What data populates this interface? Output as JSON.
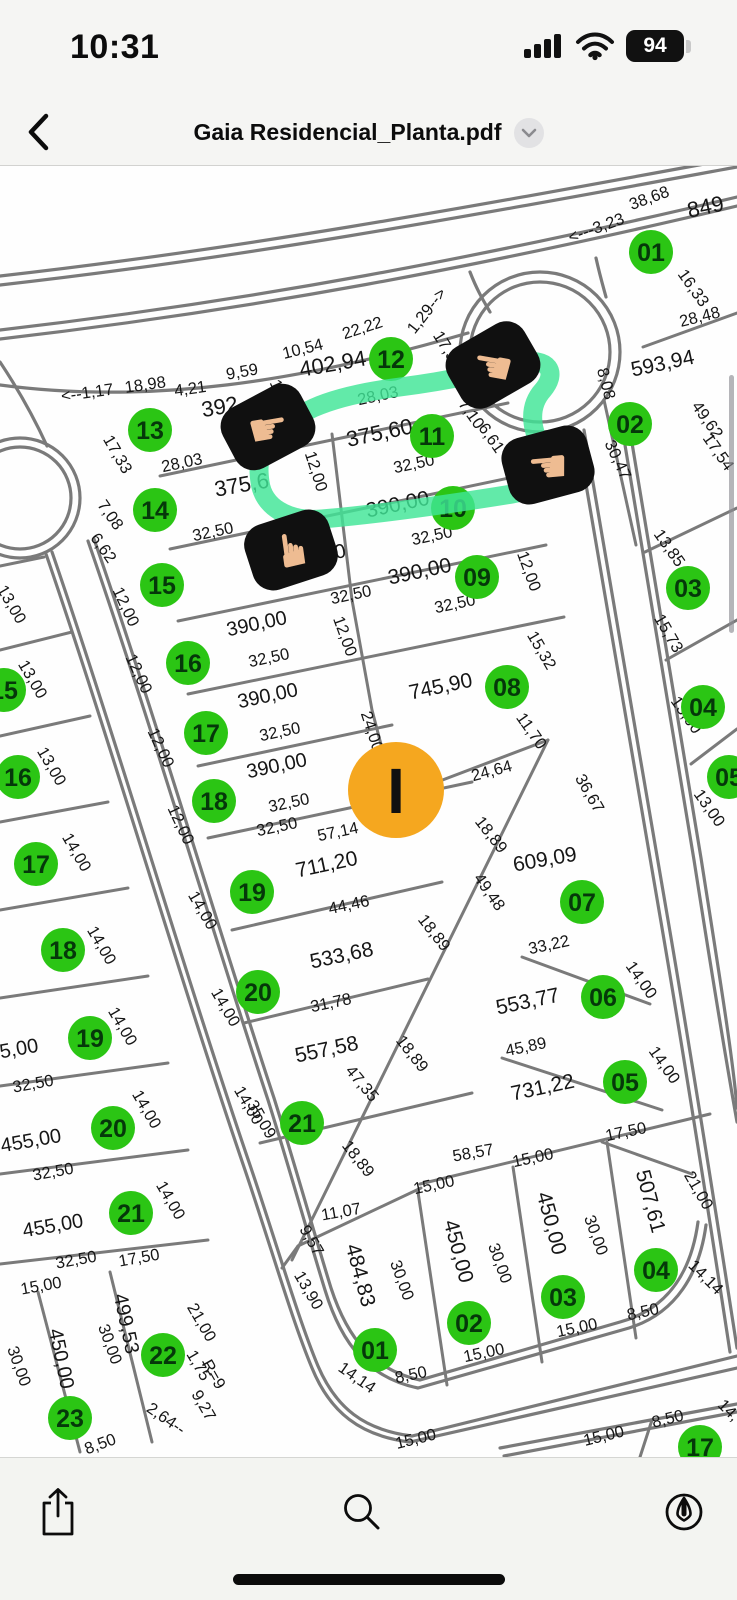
{
  "status_bar": {
    "time": "10:31",
    "battery_percent": "94",
    "icons": [
      "cellular-signal-icon",
      "wifi-icon",
      "battery-icon"
    ]
  },
  "nav_bar": {
    "title": "Gaia Residencial_Planta.pdf",
    "icons": [
      "back-chevron-icon",
      "title-disclosure-chevron-icon"
    ]
  },
  "toolbar": {
    "icons": [
      "share-icon",
      "search-icon",
      "markup-icon"
    ]
  },
  "colors": {
    "circle_green": "#2bc514",
    "circle_text": "#05380a",
    "highlight": "#3fe596",
    "marker_orange": "#f5a71f",
    "street_gray": "#7a7a7a",
    "label_black": "#161616",
    "sticker_bg": "#101010",
    "hand_skin": "#eebc92",
    "scrollbar_gray": "#8e8e93"
  },
  "map": {
    "marker": {
      "letter": "I",
      "x": 396,
      "y": 790
    },
    "stickers": [
      {
        "glyph": "☛",
        "x": 268,
        "y": 427,
        "rot": -28,
        "grot": 18
      },
      {
        "glyph": "☚",
        "x": 493,
        "y": 365,
        "rot": -30,
        "grot": 40
      },
      {
        "glyph": "☚",
        "x": 548,
        "y": 465,
        "rot": -15,
        "grot": 10
      },
      {
        "glyph": "☛",
        "x": 291,
        "y": 550,
        "rot": -18,
        "grot": -80
      }
    ],
    "lots": [
      {
        "n": "13",
        "x": 150,
        "y": 430
      },
      {
        "n": "14",
        "x": 155,
        "y": 510
      },
      {
        "n": "15",
        "x": 162,
        "y": 585
      },
      {
        "n": "16",
        "x": 188,
        "y": 663
      },
      {
        "n": "17",
        "x": 206,
        "y": 733
      },
      {
        "n": "18",
        "x": 214,
        "y": 801
      },
      {
        "n": "19",
        "x": 252,
        "y": 892
      },
      {
        "n": "20",
        "x": 258,
        "y": 992
      },
      {
        "n": "21",
        "x": 302,
        "y": 1123
      },
      {
        "n": "12",
        "x": 391,
        "y": 359
      },
      {
        "n": "11",
        "x": 432,
        "y": 436
      },
      {
        "n": "10",
        "x": 453,
        "y": 508
      },
      {
        "n": "09",
        "x": 477,
        "y": 577
      },
      {
        "n": "08",
        "x": 507,
        "y": 687
      },
      {
        "n": "07",
        "x": 582,
        "y": 902
      },
      {
        "n": "06",
        "x": 603,
        "y": 997
      },
      {
        "n": "05",
        "x": 625,
        "y": 1082
      },
      {
        "n": "01",
        "x": 651,
        "y": 252
      },
      {
        "n": "02",
        "x": 630,
        "y": 424
      },
      {
        "n": "03",
        "x": 688,
        "y": 588
      },
      {
        "n": "04",
        "x": 703,
        "y": 707
      },
      {
        "n": "05",
        "x": 729,
        "y": 777
      },
      {
        "n": "15",
        "x": 4,
        "y": 690
      },
      {
        "n": "16",
        "x": 18,
        "y": 777
      },
      {
        "n": "17",
        "x": 36,
        "y": 864
      },
      {
        "n": "18",
        "x": 63,
        "y": 950
      },
      {
        "n": "19",
        "x": 90,
        "y": 1038
      },
      {
        "n": "20",
        "x": 113,
        "y": 1128
      },
      {
        "n": "21",
        "x": 131,
        "y": 1213
      },
      {
        "n": "22",
        "x": 163,
        "y": 1355
      },
      {
        "n": "23",
        "x": 70,
        "y": 1418
      },
      {
        "n": "01",
        "x": 375,
        "y": 1350
      },
      {
        "n": "02",
        "x": 469,
        "y": 1323
      },
      {
        "n": "03",
        "x": 563,
        "y": 1297
      },
      {
        "n": "04",
        "x": 656,
        "y": 1270
      },
      {
        "n": "17",
        "x": 700,
        "y": 1447
      }
    ],
    "labels": [
      {
        "t": "<--1,17",
        "x": 88,
        "y": 398,
        "r": -8
      },
      {
        "t": "18,98",
        "x": 146,
        "y": 390,
        "r": -8
      },
      {
        "t": "4,21",
        "x": 191,
        "y": 394,
        "r": -8
      },
      {
        "t": "9,59",
        "x": 243,
        "y": 377,
        "r": -10
      },
      {
        "t": "10,54",
        "x": 304,
        "y": 354,
        "r": -14
      },
      {
        "t": "22,22",
        "x": 364,
        "y": 333,
        "r": -18
      },
      {
        "t": "402,94",
        "x": 334,
        "y": 371,
        "r": -10,
        "s": 22
      },
      {
        "t": "1,29-->",
        "x": 431,
        "y": 314,
        "r": -52
      },
      {
        "t": "17,3",
        "x": 441,
        "y": 349,
        "r": 58
      },
      {
        "t": "12,",
        "x": 274,
        "y": 393,
        "r": 66
      },
      {
        "t": "28,03",
        "x": 379,
        "y": 401,
        "r": -12
      },
      {
        "t": "392",
        "x": 221,
        "y": 414,
        "r": -10,
        "s": 22
      },
      {
        "t": "38,68",
        "x": 651,
        "y": 203,
        "r": -20
      },
      {
        "t": "849",
        "x": 707,
        "y": 214,
        "r": -12,
        "s": 22
      },
      {
        "t": "<---3,23",
        "x": 598,
        "y": 233,
        "r": -20
      },
      {
        "t": "16,33",
        "x": 689,
        "y": 291,
        "r": 55
      },
      {
        "t": "28,48",
        "x": 701,
        "y": 322,
        "r": -14
      },
      {
        "t": "593,94",
        "x": 664,
        "y": 370,
        "r": -12,
        "s": 21
      },
      {
        "t": "8,08",
        "x": 601,
        "y": 385,
        "r": 75
      },
      {
        "t": "30,47",
        "x": 613,
        "y": 462,
        "r": 65
      },
      {
        "t": "49,62",
        "x": 703,
        "y": 423,
        "r": 55
      },
      {
        "t": "17,54",
        "x": 714,
        "y": 455,
        "r": 55
      },
      {
        "t": "17,33",
        "x": 113,
        "y": 457,
        "r": 60
      },
      {
        "t": "28,03",
        "x": 183,
        "y": 468,
        "r": -12
      },
      {
        "t": "375,6",
        "x": 243,
        "y": 492,
        "r": -10,
        "s": 22
      },
      {
        "t": "32,50",
        "x": 214,
        "y": 537,
        "r": -12
      },
      {
        "t": "7,08",
        "x": 106,
        "y": 518,
        "r": 55
      },
      {
        "t": "6,62",
        "x": 99,
        "y": 551,
        "r": 55
      },
      {
        "t": "375,60",
        "x": 381,
        "y": 440,
        "r": -12,
        "s": 22
      },
      {
        "t": "32,50",
        "x": 415,
        "y": 469,
        "r": -12
      },
      {
        "t": "7,10",
        "x": 467,
        "y": 417,
        "r": 55
      },
      {
        "t": "6,61",
        "x": 487,
        "y": 441,
        "r": 55
      },
      {
        "t": "12,00",
        "x": 311,
        "y": 473,
        "r": 72
      },
      {
        "t": "390,00",
        "x": 399,
        "y": 511,
        "r": -12,
        "s": 21
      },
      {
        "t": "32,50",
        "x": 433,
        "y": 541,
        "r": -12
      },
      {
        "t": "390,00",
        "x": 317,
        "y": 563,
        "r": -12,
        "s": 20
      },
      {
        "t": "32,50",
        "x": 352,
        "y": 600,
        "r": -12
      },
      {
        "t": "390,00",
        "x": 421,
        "y": 578,
        "r": -12,
        "s": 21
      },
      {
        "t": "32,50",
        "x": 456,
        "y": 609,
        "r": -12
      },
      {
        "t": "12,00",
        "x": 524,
        "y": 573,
        "r": 70
      },
      {
        "t": "390,00",
        "x": 258,
        "y": 630,
        "r": -12,
        "s": 20
      },
      {
        "t": "32,50",
        "x": 270,
        "y": 663,
        "r": -12
      },
      {
        "t": "12,00",
        "x": 121,
        "y": 609,
        "r": 65
      },
      {
        "t": "390,00",
        "x": 269,
        "y": 702,
        "r": -12,
        "s": 20
      },
      {
        "t": "32,50",
        "x": 281,
        "y": 737,
        "r": -12
      },
      {
        "t": "12,00",
        "x": 134,
        "y": 676,
        "r": 65
      },
      {
        "t": "390,00",
        "x": 278,
        "y": 772,
        "r": -12,
        "s": 20
      },
      {
        "t": "32,50",
        "x": 290,
        "y": 808,
        "r": -12
      },
      {
        "t": "12,00",
        "x": 156,
        "y": 750,
        "r": 65
      },
      {
        "t": "12,00",
        "x": 176,
        "y": 827,
        "r": 65
      },
      {
        "t": "745,90",
        "x": 442,
        "y": 693,
        "r": -12,
        "s": 21
      },
      {
        "t": "15,32",
        "x": 537,
        "y": 653,
        "r": 60
      },
      {
        "t": "11,70",
        "x": 527,
        "y": 734,
        "r": 55
      },
      {
        "t": "24,64",
        "x": 493,
        "y": 776,
        "r": -15
      },
      {
        "t": "24,00",
        "x": 367,
        "y": 733,
        "r": 72
      },
      {
        "t": "12,0",
        "x": 361,
        "y": 777,
        "r": 72
      },
      {
        "t": "12,00",
        "x": 340,
        "y": 638,
        "r": 70
      },
      {
        "t": "36,67",
        "x": 585,
        "y": 796,
        "r": 60
      },
      {
        "t": "57,14",
        "x": 339,
        "y": 837,
        "r": -12
      },
      {
        "t": "32,50",
        "x": 278,
        "y": 832,
        "r": -12
      },
      {
        "t": "711,20",
        "x": 328,
        "y": 871,
        "r": -12,
        "s": 21
      },
      {
        "t": "44,46",
        "x": 350,
        "y": 910,
        "r": -12
      },
      {
        "t": "14,00",
        "x": 198,
        "y": 913,
        "r": 60
      },
      {
        "t": "533,68",
        "x": 343,
        "y": 962,
        "r": -12,
        "s": 21
      },
      {
        "t": "31,78",
        "x": 332,
        "y": 1008,
        "r": -12
      },
      {
        "t": "14,00",
        "x": 221,
        "y": 1010,
        "r": 60
      },
      {
        "t": "557,58",
        "x": 328,
        "y": 1056,
        "r": -12,
        "s": 21
      },
      {
        "t": "47,35",
        "x": 358,
        "y": 1087,
        "r": 50
      },
      {
        "t": "14,00",
        "x": 244,
        "y": 1108,
        "r": 60
      },
      {
        "t": "18,89",
        "x": 487,
        "y": 838,
        "r": 52
      },
      {
        "t": "18,89",
        "x": 430,
        "y": 936,
        "r": 52
      },
      {
        "t": "18,89",
        "x": 408,
        "y": 1057,
        "r": 52
      },
      {
        "t": "18,89",
        "x": 354,
        "y": 1162,
        "r": 52
      },
      {
        "t": "49,48",
        "x": 485,
        "y": 895,
        "r": 55
      },
      {
        "t": "609,09",
        "x": 546,
        "y": 866,
        "r": -10,
        "s": 21
      },
      {
        "t": "33,22",
        "x": 550,
        "y": 950,
        "r": -12
      },
      {
        "t": "553,77",
        "x": 529,
        "y": 1008,
        "r": -12,
        "s": 21
      },
      {
        "t": "45,89",
        "x": 527,
        "y": 1052,
        "r": -12
      },
      {
        "t": "14,00",
        "x": 637,
        "y": 983,
        "r": 55
      },
      {
        "t": "731,22",
        "x": 544,
        "y": 1094,
        "r": -12,
        "s": 21
      },
      {
        "t": "17,50",
        "x": 627,
        "y": 1137,
        "r": -12
      },
      {
        "t": "14,00",
        "x": 660,
        "y": 1068,
        "r": 55
      },
      {
        "t": "58,57",
        "x": 474,
        "y": 1158,
        "r": -10
      },
      {
        "t": "15,00",
        "x": 534,
        "y": 1163,
        "r": -12
      },
      {
        "t": "15,00",
        "x": 435,
        "y": 1190,
        "r": -12
      },
      {
        "t": "11,07",
        "x": 342,
        "y": 1217,
        "r": -10
      },
      {
        "t": "9,57",
        "x": 307,
        "y": 1243,
        "r": 60
      },
      {
        "t": "13,90",
        "x": 304,
        "y": 1293,
        "r": 60
      },
      {
        "t": "484,83",
        "x": 354,
        "y": 1277,
        "r": 75,
        "s": 21
      },
      {
        "t": "30,00",
        "x": 397,
        "y": 1282,
        "r": 70
      },
      {
        "t": "450,00",
        "x": 452,
        "y": 1253,
        "r": 75,
        "s": 21
      },
      {
        "t": "30,00",
        "x": 495,
        "y": 1265,
        "r": 70
      },
      {
        "t": "450,00",
        "x": 545,
        "y": 1225,
        "r": 75,
        "s": 21
      },
      {
        "t": "30,00",
        "x": 591,
        "y": 1237,
        "r": 70
      },
      {
        "t": "507,61",
        "x": 644,
        "y": 1203,
        "r": 75,
        "s": 21
      },
      {
        "t": "21,00",
        "x": 694,
        "y": 1193,
        "r": 60
      },
      {
        "t": "14,14",
        "x": 354,
        "y": 1382,
        "r": 35
      },
      {
        "t": "8,50",
        "x": 412,
        "y": 1380,
        "r": -12
      },
      {
        "t": "15,00",
        "x": 485,
        "y": 1358,
        "r": -12
      },
      {
        "t": "15,00",
        "x": 578,
        "y": 1333,
        "r": -12
      },
      {
        "t": "8,50",
        "x": 644,
        "y": 1317,
        "r": -12
      },
      {
        "t": "14,14",
        "x": 702,
        "y": 1281,
        "r": 45
      },
      {
        "t": "13,85",
        "x": 665,
        "y": 551,
        "r": 55
      },
      {
        "t": "15,73",
        "x": 664,
        "y": 636,
        "r": 60
      },
      {
        "t": "13,00",
        "x": 682,
        "y": 718,
        "r": 55
      },
      {
        "t": "13,00",
        "x": 705,
        "y": 811,
        "r": 55
      },
      {
        "t": "13,00",
        "x": 7,
        "y": 607,
        "r": 60
      },
      {
        "t": "13,00",
        "x": 28,
        "y": 682,
        "r": 60
      },
      {
        "t": "13,00",
        "x": 47,
        "y": 769,
        "r": 60
      },
      {
        "t": "14,00",
        "x": 72,
        "y": 855,
        "r": 60
      },
      {
        "t": "14,00",
        "x": 97,
        "y": 948,
        "r": 60
      },
      {
        "t": "14,00",
        "x": 118,
        "y": 1029,
        "r": 60
      },
      {
        "t": "14,00",
        "x": 142,
        "y": 1112,
        "r": 60
      },
      {
        "t": "14,00",
        "x": 166,
        "y": 1203,
        "r": 60
      },
      {
        "t": "5,00",
        "x": 20,
        "y": 1055,
        "r": -10,
        "s": 20
      },
      {
        "t": "32,50",
        "x": 34,
        "y": 1089,
        "r": -10
      },
      {
        "t": "455,00",
        "x": 32,
        "y": 1147,
        "r": -10,
        "s": 20
      },
      {
        "t": "32,50",
        "x": 54,
        "y": 1177,
        "r": -10
      },
      {
        "t": "455,00",
        "x": 54,
        "y": 1232,
        "r": -10,
        "s": 20
      },
      {
        "t": "32,50",
        "x": 77,
        "y": 1265,
        "r": -10
      },
      {
        "t": "15,00",
        "x": 42,
        "y": 1291,
        "r": -10
      },
      {
        "t": "17,50",
        "x": 140,
        "y": 1263,
        "r": -10
      },
      {
        "t": "450,00",
        "x": 55,
        "y": 1360,
        "r": 78,
        "s": 20
      },
      {
        "t": "30,00",
        "x": 14,
        "y": 1368,
        "r": 70
      },
      {
        "t": "30,00",
        "x": 105,
        "y": 1346,
        "r": 70
      },
      {
        "t": "499,53",
        "x": 120,
        "y": 1325,
        "r": 78,
        "s": 20
      },
      {
        "t": "21,00",
        "x": 197,
        "y": 1325,
        "r": 60
      },
      {
        "t": "1,75",
        "x": 194,
        "y": 1368,
        "r": 60
      },
      {
        "t": "R=9",
        "x": 209,
        "y": 1377,
        "r": 60
      },
      {
        "t": "9,27",
        "x": 199,
        "y": 1408,
        "r": 60
      },
      {
        "t": "2,64--",
        "x": 163,
        "y": 1423,
        "r": 35
      },
      {
        "t": "35,09",
        "x": 257,
        "y": 1122,
        "r": 60
      },
      {
        "t": "8,50",
        "x": 102,
        "y": 1449,
        "r": -20
      },
      {
        "t": "15,00",
        "x": 417,
        "y": 1444,
        "r": -14
      },
      {
        "t": "15,00",
        "x": 605,
        "y": 1441,
        "r": -14
      },
      {
        "t": "8,50",
        "x": 669,
        "y": 1424,
        "r": -14
      },
      {
        "t": "14,",
        "x": 725,
        "y": 1414,
        "r": 45
      }
    ]
  }
}
